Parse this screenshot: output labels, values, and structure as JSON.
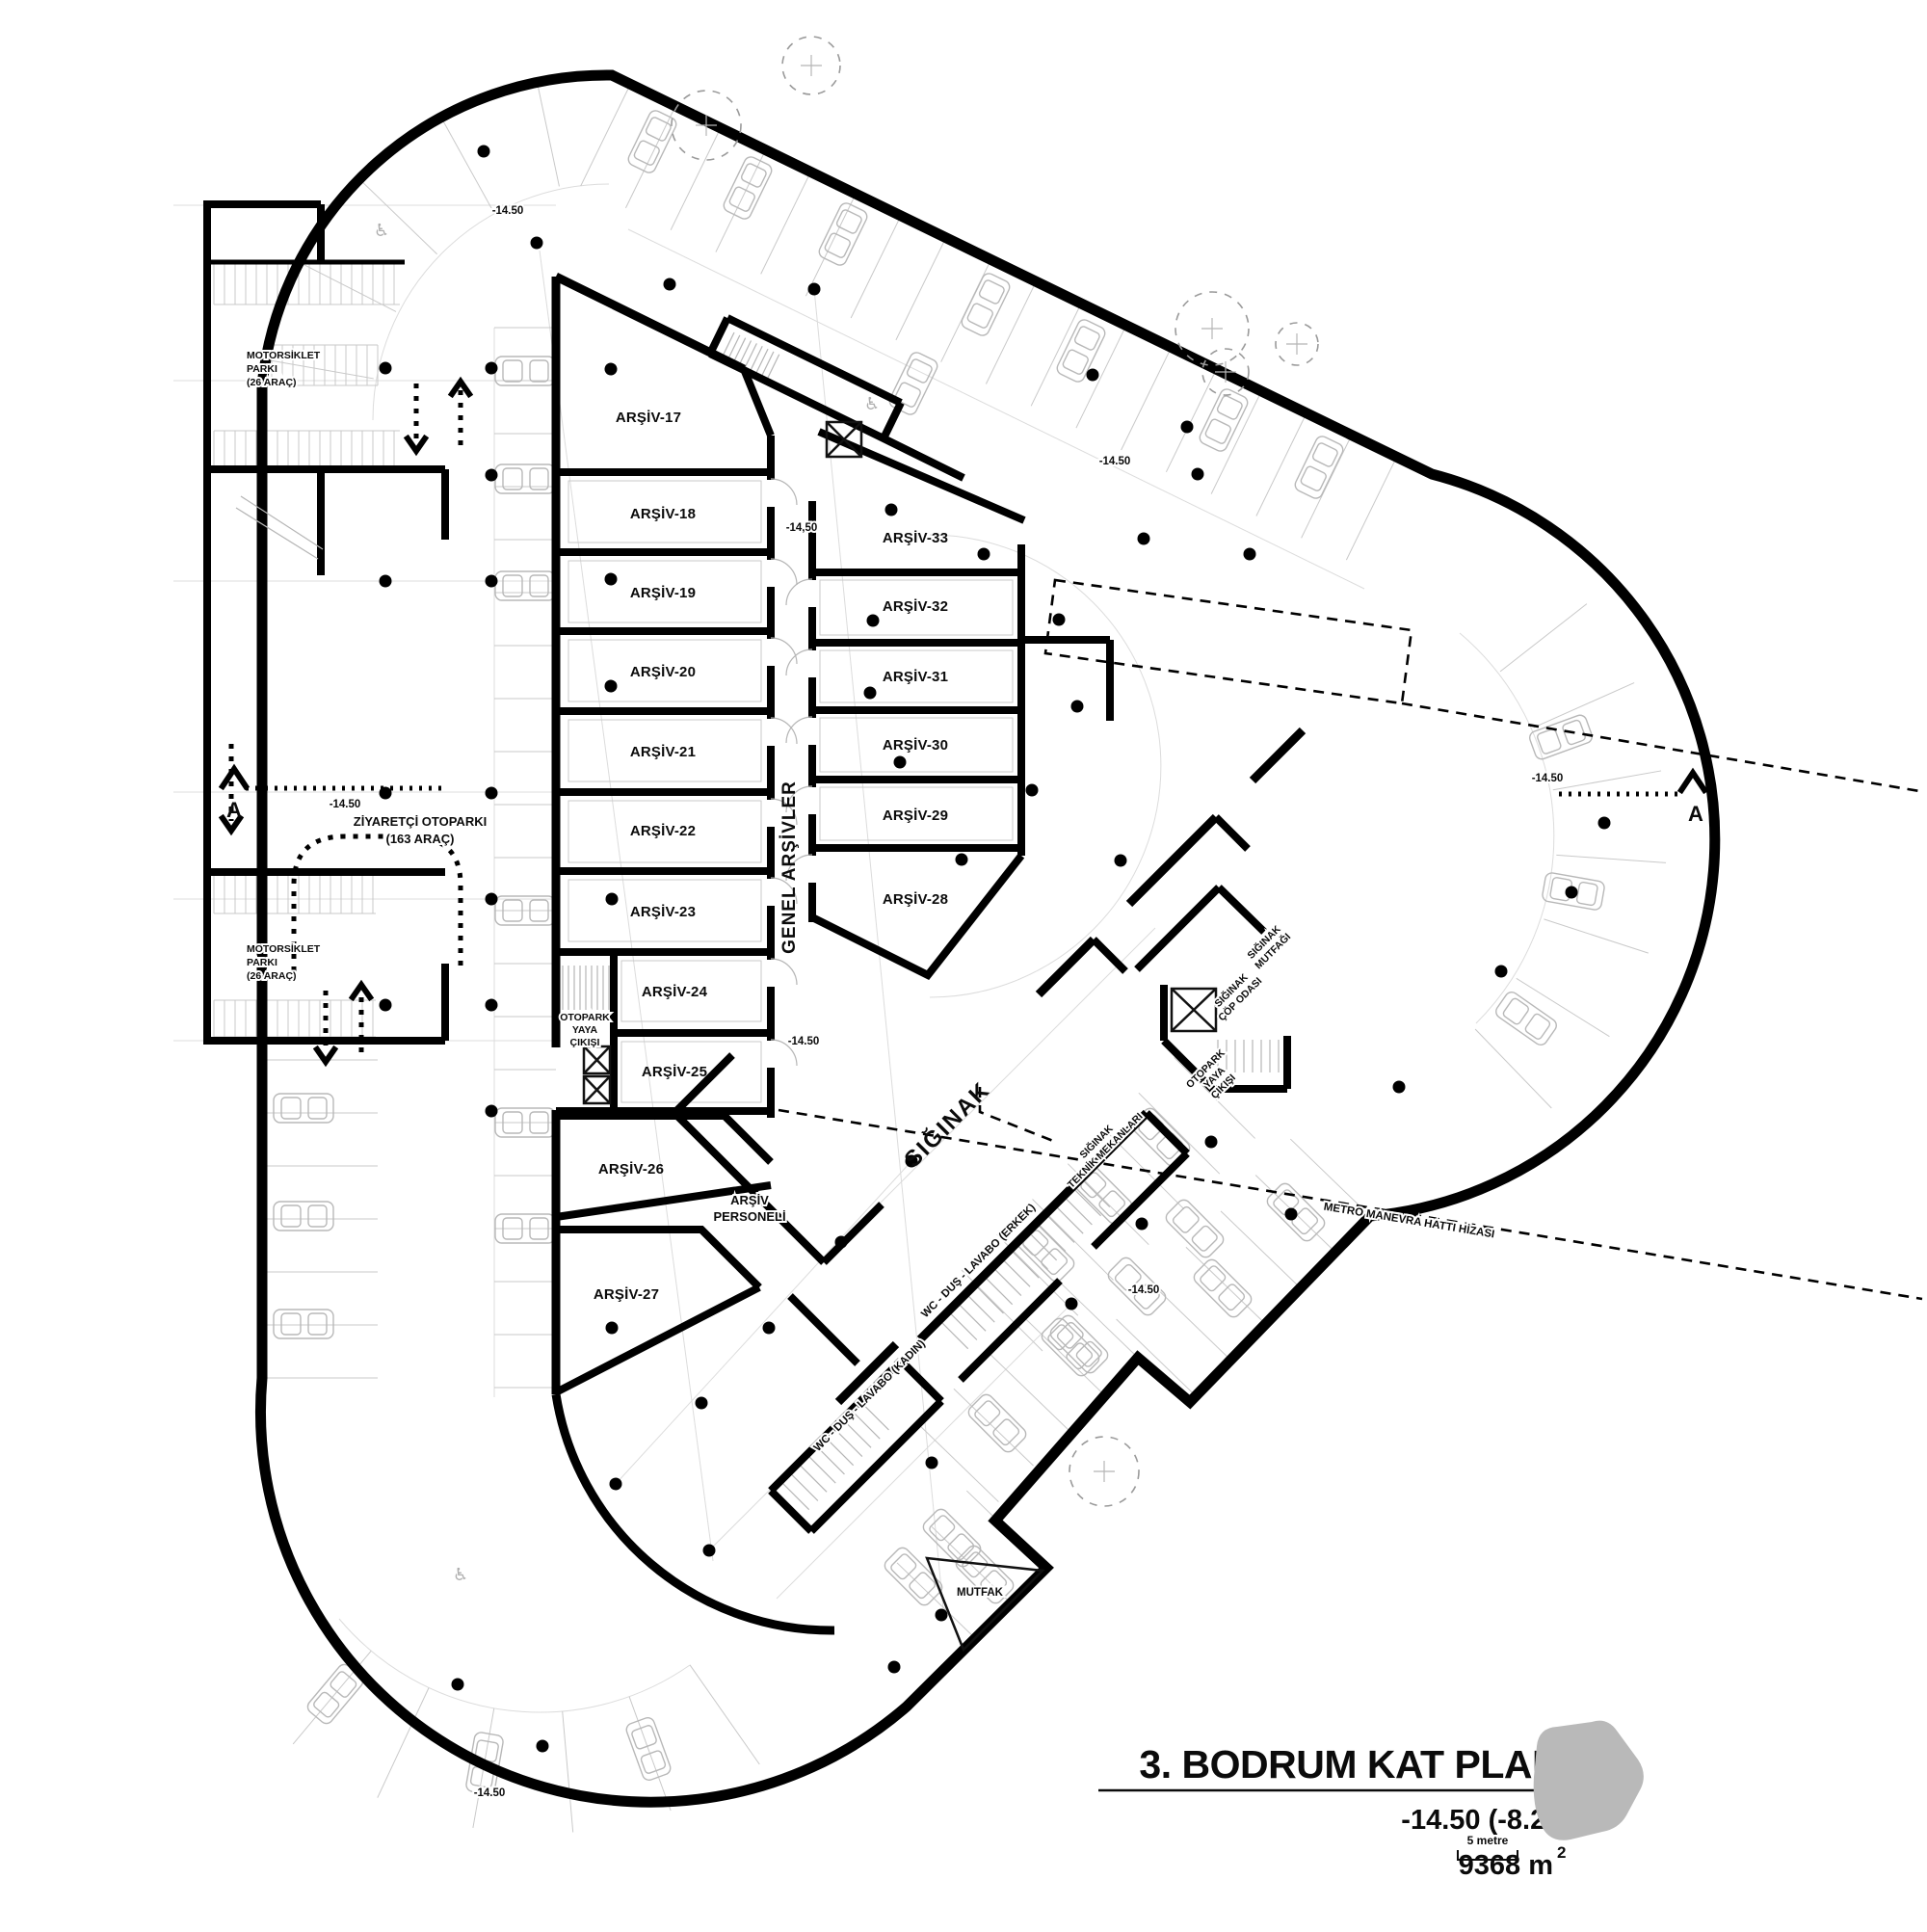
{
  "title_block": {
    "title": "3. BODRUM KAT PLANI",
    "level": "-14.50 (-8.20)",
    "area": "9368 m",
    "area_sup": "2",
    "scale": "5 metre"
  },
  "markers": {
    "level": "-14.50",
    "level_comma": "-14,50",
    "section": "A"
  },
  "annex": {
    "moto1": "MOTORSİKLET",
    "moto2": "PARKI",
    "moto3": "(26 ARAÇ)",
    "visitor1": "ZİYARETÇİ OTOPARKI",
    "visitor2": "(163 ARAÇ)"
  },
  "exit": {
    "l1": "OTOPARK",
    "l2": "YAYA",
    "l3": "ÇIKIŞI"
  },
  "archive": {
    "corridor": "GENEL ARŞİVLER",
    "pers1": "ARŞİV",
    "pers2": "PERSONELİ",
    "left": [
      "ARŞİV-17",
      "ARŞİV-18",
      "ARŞİV-19",
      "ARŞİV-20",
      "ARŞİV-21",
      "ARŞİV-22",
      "ARŞİV-23",
      "ARŞİV-24",
      "ARŞİV-25",
      "ARŞİV-26",
      "ARŞİV-27"
    ],
    "right": [
      "ARŞİV-33",
      "ARŞİV-32",
      "ARŞİV-31",
      "ARŞİV-30",
      "ARŞİV-29",
      "ARŞİV-28"
    ]
  },
  "shelter": {
    "name": "SIĞINAK",
    "kitchen1": "SIĞINAK",
    "kitchen2": "MUTFAĞI",
    "trash1": "SIĞINAK",
    "trash2": "ÇÖP ODASI",
    "tech1": "SIĞINAK",
    "tech2": "TEKNİK MEKANLARI",
    "wc_men": "WC - DUŞ - LAVABO (ERKEK)",
    "wc_women": "WC - DUŞ - LAVABO (KADIN)",
    "mutfak": "MUTFAK"
  },
  "metro": {
    "note": "METRO MANEVRA HATTI HİZASI"
  }
}
